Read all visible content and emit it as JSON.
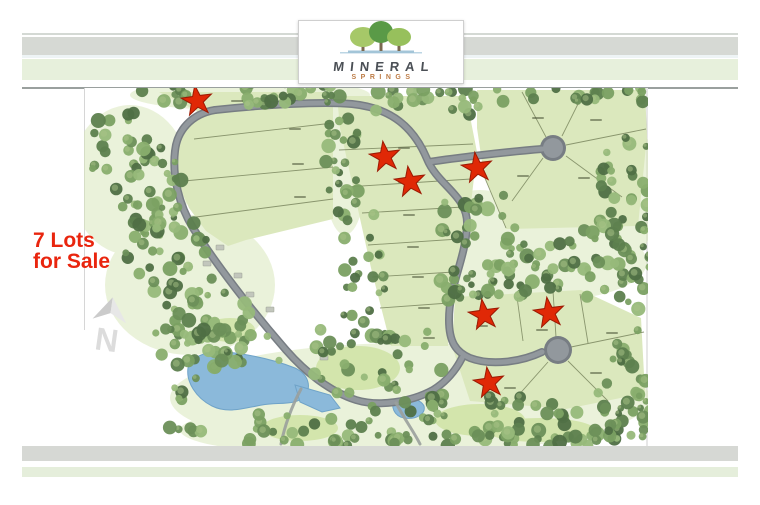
{
  "logo": {
    "title": "MINERAL",
    "subtitle": "SPRINGS"
  },
  "tagline": {
    "line1": "7 Lots",
    "line2": "for Sale"
  },
  "compass": {
    "label": "N"
  },
  "map": {
    "for_sale_star_count": 7,
    "stars": [
      {
        "x": 197,
        "y": 101
      },
      {
        "x": 385,
        "y": 157
      },
      {
        "x": 410,
        "y": 182
      },
      {
        "x": 477,
        "y": 168
      },
      {
        "x": 484,
        "y": 315
      },
      {
        "x": 549,
        "y": 313
      },
      {
        "x": 489,
        "y": 383
      }
    ]
  },
  "colors": {
    "tagline_red": "#e9250e",
    "star_fill": "#e02806",
    "star_stroke": "#9c1a04",
    "band_gray": "#d6d9d4",
    "band_green": "#e7f0dc",
    "lot_fill": "#dbe8bd",
    "road_gray": "#777d83",
    "pond_blue": "#8bb9da",
    "logo_text": "#4b5056",
    "logo_subtext": "#bd7c46"
  }
}
